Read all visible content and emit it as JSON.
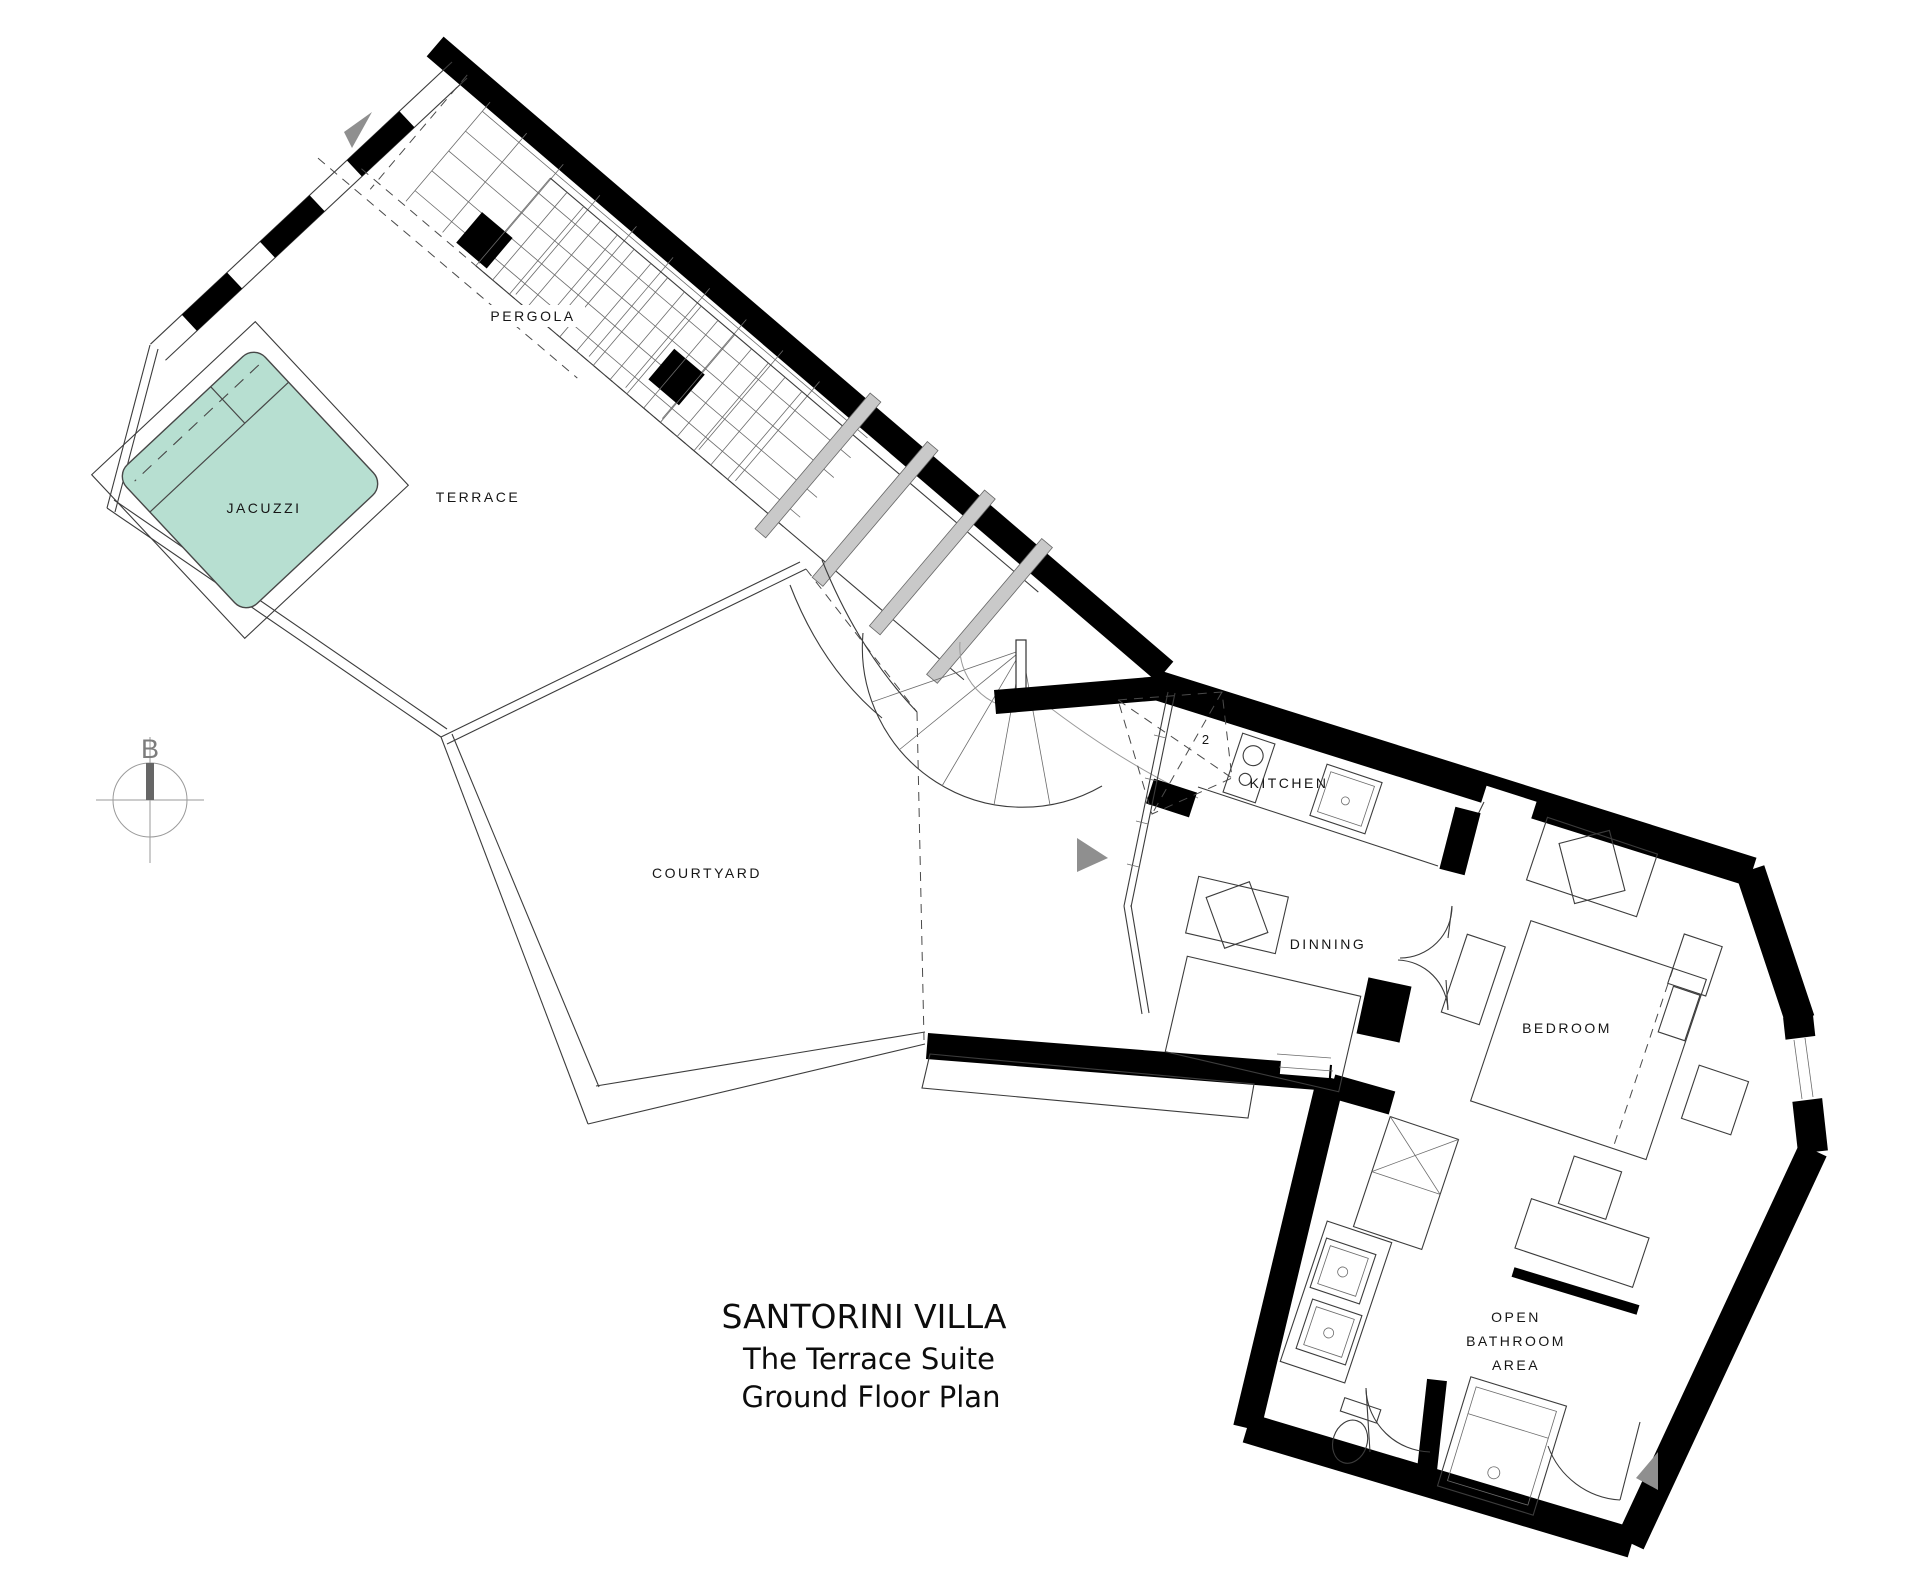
{
  "title": {
    "line1": "SANTORINI VILLA",
    "line2": "The Terrace Suite",
    "line3": "Ground Floor Plan"
  },
  "rooms": {
    "jacuzzi": "JACUZZI",
    "terrace": "TERRACE",
    "pergola": "PERGOLA",
    "courtyard": "COURTYARD",
    "kitchen": "KITCHEN",
    "dining": "DINNING",
    "bedroom": "BEDROOM",
    "bathroom_line1": "OPEN",
    "bathroom_line2": "BATHROOM",
    "bathroom_line3": "AREA"
  },
  "annotations": {
    "stair_count": "2",
    "compass_letter": "B"
  },
  "colors": {
    "jacuzzi_fill": "#b7dfd1",
    "jacuzzi_stroke": "#474747",
    "wall": "#000000",
    "beam_fill": "#c9c9c9",
    "arrow": "#8f8f8f",
    "compass": "#8a8a8a"
  }
}
